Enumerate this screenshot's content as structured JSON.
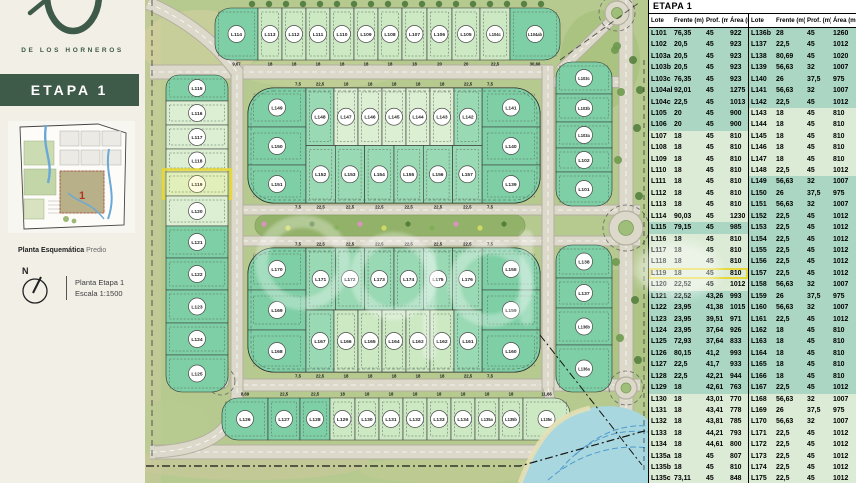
{
  "colors": {
    "accent_green": "#3e5a48",
    "teal_row": "#abd6c4",
    "pale_row": "#dcebd5",
    "lot_teal": "#7ecfa5",
    "lot_med": "#99d9b3",
    "lot_light": "#cde9c4",
    "lot_pale": "#dcefd2",
    "road": "#dcd9cb",
    "road_edge": "#b3b0a0",
    "water": "#a9d7df",
    "highlight": "#e6d83a"
  },
  "sidebar": {
    "brand": "DE LOS HORNEROS",
    "stage_label": "ETAPA 1",
    "map_caption_bold": "Planta Esquemática",
    "map_caption_regular": "Predio",
    "mini_map_stage_number": "1",
    "compass_label": "N",
    "plan_title": "Planta Etapa 1",
    "plan_scale": "Escala 1:1500"
  },
  "table": {
    "title": "ETAPA 1",
    "columns": [
      "Lote",
      "Frente (m)",
      "Prof. (m)",
      "Área (m²)"
    ],
    "highlight_lote": "L119",
    "left_rows": [
      [
        "L101",
        "76,35",
        "45",
        "922",
        "t"
      ],
      [
        "L102",
        "20,5",
        "45",
        "923",
        "t"
      ],
      [
        "L103a",
        "20,5",
        "45",
        "923",
        "t"
      ],
      [
        "L103b",
        "20,5",
        "45",
        "923",
        "t"
      ],
      [
        "L103c",
        "76,35",
        "45",
        "923",
        "t"
      ],
      [
        "L104ab",
        "92,01",
        "45",
        "1275",
        "t"
      ],
      [
        "L104c",
        "22,5",
        "45",
        "1013",
        "t"
      ],
      [
        "L105",
        "20",
        "45",
        "900",
        "t"
      ],
      [
        "L106",
        "20",
        "45",
        "900",
        "t"
      ],
      [
        "L107",
        "18",
        "45",
        "810",
        "p"
      ],
      [
        "L108",
        "18",
        "45",
        "810",
        "p"
      ],
      [
        "L109",
        "18",
        "45",
        "810",
        "p"
      ],
      [
        "L110",
        "18",
        "45",
        "810",
        "p"
      ],
      [
        "L111",
        "18",
        "45",
        "810",
        "p"
      ],
      [
        "L112",
        "18",
        "45",
        "810",
        "p"
      ],
      [
        "L113",
        "18",
        "45",
        "810",
        "p"
      ],
      [
        "L114",
        "90,03",
        "45",
        "1230",
        "p"
      ],
      [
        "L115",
        "79,15",
        "45",
        "985",
        "t"
      ],
      [
        "L116",
        "18",
        "45",
        "810",
        "p"
      ],
      [
        "L117",
        "18",
        "45",
        "810",
        "p"
      ],
      [
        "L118",
        "18",
        "45",
        "810",
        "p"
      ],
      [
        "L119",
        "18",
        "45",
        "810",
        "p"
      ],
      [
        "L120",
        "22,52",
        "45",
        "1012",
        "p"
      ],
      [
        "L121",
        "22,52",
        "43,26",
        "993",
        "t"
      ],
      [
        "L122",
        "23,95",
        "41,38",
        "1015",
        "t"
      ],
      [
        "L123",
        "23,95",
        "39,51",
        "971",
        "t"
      ],
      [
        "L124",
        "23,95",
        "37,64",
        "926",
        "t"
      ],
      [
        "L125",
        "72,93",
        "37,64",
        "833",
        "t"
      ],
      [
        "L126",
        "80,15",
        "41,2",
        "993",
        "t"
      ],
      [
        "L127",
        "22,5",
        "41,7",
        "933",
        "t"
      ],
      [
        "L128",
        "22,5",
        "42,21",
        "944",
        "t"
      ],
      [
        "L129",
        "18",
        "42,61",
        "763",
        "t"
      ],
      [
        "L130",
        "18",
        "43,01",
        "770",
        "p"
      ],
      [
        "L131",
        "18",
        "43,41",
        "778",
        "p"
      ],
      [
        "L132",
        "18",
        "43,81",
        "785",
        "p"
      ],
      [
        "L133",
        "18",
        "44,21",
        "793",
        "p"
      ],
      [
        "L134",
        "18",
        "44,61",
        "800",
        "p"
      ],
      [
        "L135a",
        "18",
        "45",
        "807",
        "p"
      ],
      [
        "L135b",
        "18",
        "45",
        "810",
        "p"
      ],
      [
        "L135c",
        "73,11",
        "45",
        "848",
        "p"
      ]
    ],
    "right_rows": [
      [
        "L136b",
        "28",
        "45",
        "1260",
        "t"
      ],
      [
        "L137",
        "22,5",
        "45",
        "1012",
        "t"
      ],
      [
        "L138",
        "80,69",
        "45",
        "1020",
        "t"
      ],
      [
        "L139",
        "56,63",
        "32",
        "1007",
        "t"
      ],
      [
        "L140",
        "26",
        "37,5",
        "975",
        "t"
      ],
      [
        "L141",
        "56,63",
        "32",
        "1007",
        "t"
      ],
      [
        "L142",
        "22,5",
        "45",
        "1012",
        "t"
      ],
      [
        "L143",
        "18",
        "45",
        "810",
        "p"
      ],
      [
        "L144",
        "18",
        "45",
        "810",
        "p"
      ],
      [
        "L145",
        "18",
        "45",
        "810",
        "p"
      ],
      [
        "L146",
        "18",
        "45",
        "810",
        "p"
      ],
      [
        "L147",
        "18",
        "45",
        "810",
        "p"
      ],
      [
        "L148",
        "22,5",
        "45",
        "1012",
        "p"
      ],
      [
        "L149",
        "56,63",
        "32",
        "1007",
        "t"
      ],
      [
        "L150",
        "26",
        "37,5",
        "975",
        "t"
      ],
      [
        "L151",
        "56,63",
        "32",
        "1007",
        "t"
      ],
      [
        "L152",
        "22,5",
        "45",
        "1012",
        "t"
      ],
      [
        "L153",
        "22,5",
        "45",
        "1012",
        "t"
      ],
      [
        "L154",
        "22,5",
        "45",
        "1012",
        "t"
      ],
      [
        "L155",
        "22,5",
        "45",
        "1012",
        "t"
      ],
      [
        "L156",
        "22,5",
        "45",
        "1012",
        "t"
      ],
      [
        "L157",
        "22,5",
        "45",
        "1012",
        "t"
      ],
      [
        "L158",
        "56,63",
        "32",
        "1007",
        "t"
      ],
      [
        "L159",
        "26",
        "37,5",
        "975",
        "t"
      ],
      [
        "L160",
        "56,63",
        "32",
        "1007",
        "t"
      ],
      [
        "L161",
        "22,5",
        "45",
        "1012",
        "t"
      ],
      [
        "L162",
        "18",
        "45",
        "810",
        "t"
      ],
      [
        "L163",
        "18",
        "45",
        "810",
        "t"
      ],
      [
        "L164",
        "18",
        "45",
        "810",
        "t"
      ],
      [
        "L165",
        "18",
        "45",
        "810",
        "t"
      ],
      [
        "L166",
        "18",
        "45",
        "810",
        "t"
      ],
      [
        "L167",
        "22,5",
        "45",
        "1012",
        "t"
      ],
      [
        "L168",
        "56,63",
        "32",
        "1007",
        "p"
      ],
      [
        "L169",
        "26",
        "37,5",
        "975",
        "p"
      ],
      [
        "L170",
        "56,63",
        "32",
        "1007",
        "p"
      ],
      [
        "L171",
        "22,5",
        "45",
        "1012",
        "p"
      ],
      [
        "L172",
        "22,5",
        "45",
        "1012",
        "p"
      ],
      [
        "L173",
        "22,5",
        "45",
        "1012",
        "p"
      ],
      [
        "L174",
        "22,5",
        "45",
        "1012",
        "p"
      ],
      [
        "L175",
        "22,5",
        "45",
        "1012",
        "p"
      ]
    ]
  },
  "map": {
    "highlight_lote": "L119",
    "top_strip": {
      "x": 215,
      "y": 8,
      "h": 52,
      "dimPos": "below",
      "lots": [
        {
          "label": "L114",
          "w": 43,
          "shade": "teal",
          "cap": "L",
          "dim": "9,67"
        },
        {
          "label": "L113",
          "w": 24,
          "shade": "light",
          "dim": "18"
        },
        {
          "label": "L112",
          "w": 24,
          "shade": "light",
          "dim": "18"
        },
        {
          "label": "L111",
          "w": 24,
          "shade": "light",
          "dim": "18"
        },
        {
          "label": "L110",
          "w": 24,
          "shade": "light",
          "dim": "18"
        },
        {
          "label": "L109",
          "w": 24,
          "shade": "light",
          "dim": "18"
        },
        {
          "label": "L108",
          "w": 24,
          "shade": "light",
          "dim": "18"
        },
        {
          "label": "L107",
          "w": 25,
          "shade": "light",
          "dim": "18"
        },
        {
          "label": "L106",
          "w": 25,
          "shade": "light",
          "dim": "20"
        },
        {
          "label": "L105",
          "w": 28,
          "shade": "light",
          "dim": "20"
        },
        {
          "label": "L104c",
          "w": 30,
          "shade": "light",
          "dim": "22,5"
        },
        {
          "label": "L104ab",
          "w": 50,
          "shade": "teal",
          "cap": "R",
          "dim": "30,66"
        }
      ]
    },
    "left_column": {
      "x": 166,
      "y": 75,
      "w": 62,
      "lots": [
        {
          "label": "L115",
          "h": 26,
          "shade": "teal",
          "cap": "T",
          "dim": ""
        },
        {
          "label": "L116",
          "h": 24,
          "shade": "pale",
          "dim": "45"
        },
        {
          "label": "L117",
          "h": 24,
          "shade": "pale",
          "dim": "45"
        },
        {
          "label": "L118",
          "h": 23,
          "shade": "pale",
          "dim": "45"
        },
        {
          "label": "L119",
          "h": 24,
          "shade": "pale",
          "dim": "45",
          "highlight": true
        },
        {
          "label": "L120",
          "h": 30,
          "shade": "pale",
          "dim": "45"
        },
        {
          "label": "L121",
          "h": 32,
          "shade": "teal",
          "dim": "43,26"
        },
        {
          "label": "L122",
          "h": 32,
          "shade": "teal",
          "dim": "41,38"
        },
        {
          "label": "L123",
          "h": 33,
          "shade": "teal",
          "dim": "39,51"
        },
        {
          "label": "L124",
          "h": 32,
          "shade": "teal",
          "dim": "37,64"
        },
        {
          "label": "L125",
          "h": 37,
          "shade": "teal",
          "cap": "B",
          "dim": ""
        }
      ]
    },
    "right_column_upper": {
      "x": 556,
      "y": 62,
      "w": 56,
      "lots": [
        {
          "label": "L103c",
          "h": 32,
          "shade": "teal",
          "cap": "T",
          "dim": "45"
        },
        {
          "label": "L103b",
          "h": 28,
          "shade": "teal",
          "dim": "45"
        },
        {
          "label": "L103a",
          "h": 26,
          "shade": "teal",
          "dim": "45"
        },
        {
          "label": "L102",
          "h": 24,
          "shade": "teal",
          "dim": "45"
        },
        {
          "label": "L101",
          "h": 34,
          "shade": "teal",
          "cap": "B",
          "dim": ""
        }
      ]
    },
    "right_column_lower": {
      "x": 556,
      "y": 245,
      "w": 56,
      "lots": [
        {
          "label": "L138",
          "h": 33,
          "shade": "teal",
          "cap": "T",
          "dim": "45"
        },
        {
          "label": "L137",
          "h": 30,
          "shade": "teal",
          "dim": "45"
        },
        {
          "label": "L136b",
          "h": 37,
          "shade": "teal",
          "dim": "45"
        },
        {
          "label": "L136a",
          "h": 47,
          "shade": "teal",
          "cap": "B",
          "dim": ""
        }
      ]
    },
    "bottom_row": {
      "x": 222,
      "y": 398,
      "h": 42,
      "dimPos": "above",
      "lots": [
        {
          "label": "L126",
          "w": 46,
          "shade": "teal",
          "cap": "L",
          "dim": "8,69"
        },
        {
          "label": "L127",
          "w": 32,
          "shade": "teal",
          "dim": "22,5"
        },
        {
          "label": "L128",
          "w": 30,
          "shade": "teal",
          "dim": "22,5"
        },
        {
          "label": "L129",
          "w": 25,
          "shade": "light",
          "dim": "18"
        },
        {
          "label": "L130",
          "w": 24,
          "shade": "light",
          "dim": "18"
        },
        {
          "label": "L131",
          "w": 24,
          "shade": "light",
          "dim": "18"
        },
        {
          "label": "L132",
          "w": 24,
          "shade": "light",
          "dim": "18"
        },
        {
          "label": "L133",
          "w": 24,
          "shade": "light",
          "dim": "18"
        },
        {
          "label": "L134",
          "w": 24,
          "shade": "light",
          "dim": "18"
        },
        {
          "label": "L135a",
          "w": 24,
          "shade": "light",
          "dim": "18"
        },
        {
          "label": "L135b",
          "w": 24,
          "shade": "light",
          "dim": "18"
        },
        {
          "label": "L135c",
          "w": 47,
          "shade": "light",
          "cap": "R",
          "dim": "11,66"
        }
      ]
    },
    "upper_block": {
      "x": 248,
      "y": 88,
      "w": 292,
      "h": 115,
      "rows": [
        39,
        38,
        38
      ],
      "left": [
        "L149",
        "L150",
        "L151"
      ],
      "right": [
        "L141",
        "L140",
        "L139"
      ],
      "top": [
        {
          "label": "L148",
          "w": 28,
          "shade": "med"
        },
        {
          "label": "L147",
          "w": 24,
          "shade": "pale"
        },
        {
          "label": "L146",
          "w": 24,
          "shade": "pale"
        },
        {
          "label": "L145",
          "w": 24,
          "shade": "pale"
        },
        {
          "label": "L144",
          "w": 24,
          "shade": "pale"
        },
        {
          "label": "L143",
          "w": 24,
          "shade": "pale"
        },
        {
          "label": "L142",
          "w": 28,
          "shade": "med"
        }
      ],
      "bottom": [
        {
          "label": "L152",
          "w": 29.3,
          "shade": "med"
        },
        {
          "label": "L153",
          "w": 29.3,
          "shade": "med"
        },
        {
          "label": "L154",
          "w": 29.4,
          "shade": "med"
        },
        {
          "label": "L155",
          "w": 29.3,
          "shade": "med"
        },
        {
          "label": "L156",
          "w": 29.3,
          "shade": "med"
        },
        {
          "label": "L157",
          "w": 29.4,
          "shade": "med"
        }
      ],
      "top_dims": [
        "7,5",
        "22,5",
        "18",
        "18",
        "18",
        "18",
        "18",
        "22,5",
        "7,5"
      ],
      "bottom_dims": [
        "7,5",
        "22,5",
        "22,5",
        "22,5",
        "22,5",
        "22,5",
        "22,5",
        "7,5"
      ],
      "side_dim": "37,5"
    },
    "lower_block": {
      "x": 248,
      "y": 248,
      "w": 292,
      "h": 124,
      "rows": [
        42,
        40,
        42
      ],
      "left": [
        "L170",
        "L169",
        "L168"
      ],
      "right": [
        "L158",
        "L159",
        "L160"
      ],
      "top": [
        {
          "label": "L171",
          "w": 29.3,
          "shade": "med"
        },
        {
          "label": "L172",
          "w": 29.3,
          "shade": "med"
        },
        {
          "label": "L173",
          "w": 29.4,
          "shade": "med"
        },
        {
          "label": "L174",
          "w": 29.3,
          "shade": "med"
        },
        {
          "label": "L175",
          "w": 29.3,
          "shade": "med"
        },
        {
          "label": "L176",
          "w": 29.4,
          "shade": "med"
        }
      ],
      "bottom": [
        {
          "label": "L167",
          "w": 28,
          "shade": "med"
        },
        {
          "label": "L166",
          "w": 24,
          "shade": "light"
        },
        {
          "label": "L165",
          "w": 24,
          "shade": "light"
        },
        {
          "label": "L164",
          "w": 24,
          "shade": "light"
        },
        {
          "label": "L163",
          "w": 24,
          "shade": "light"
        },
        {
          "label": "L162",
          "w": 24,
          "shade": "light"
        },
        {
          "label": "L161",
          "w": 28,
          "shade": "med"
        }
      ],
      "top_dims": [
        "7,5",
        "22,5",
        "22,5",
        "22,5",
        "22,5",
        "22,5",
        "22,5",
        "7,5"
      ],
      "bottom_dims": [
        "7,5",
        "22,5",
        "18",
        "18",
        "18",
        "18",
        "18",
        "22,5",
        "7,5"
      ],
      "side_dim": "37,5"
    }
  }
}
